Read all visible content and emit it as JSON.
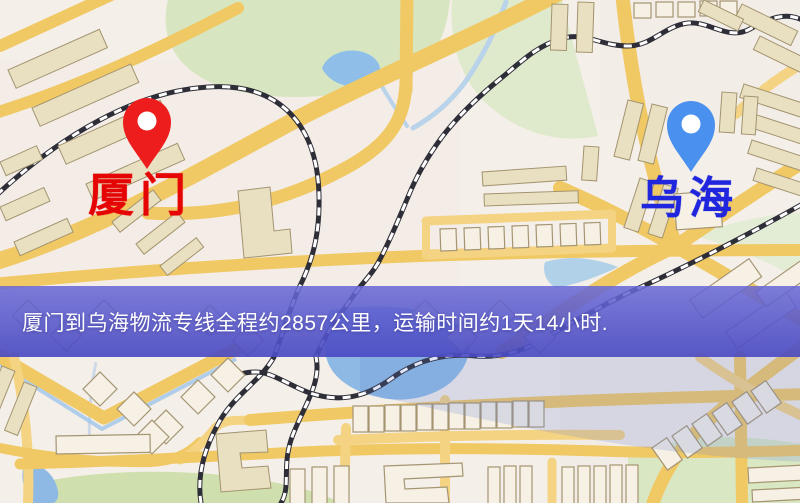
{
  "origin": {
    "name": "厦门",
    "pin_color": "#ee1d1d",
    "label_color": "#e60505"
  },
  "destination": {
    "name": "乌海",
    "pin_color": "#4a90ee",
    "label_color": "#2026dd"
  },
  "banner": {
    "text": "厦门到乌海物流专线全程约2857公里，运输时间约1天14小时.",
    "background_color": "#5656cd",
    "text_color": "#ffffff"
  },
  "route": {
    "from": "厦门",
    "to": "乌海",
    "service": "物流专线",
    "distance_km": 2857,
    "duration_days": 1,
    "duration_hours": 14
  },
  "map_colors": {
    "background": "#f4efe9",
    "road": "#f0c864",
    "water": "#8db9e4",
    "green_area": "#d7e6c0",
    "building": "#e9e0c2",
    "railway_dark": "#2e2e38"
  }
}
